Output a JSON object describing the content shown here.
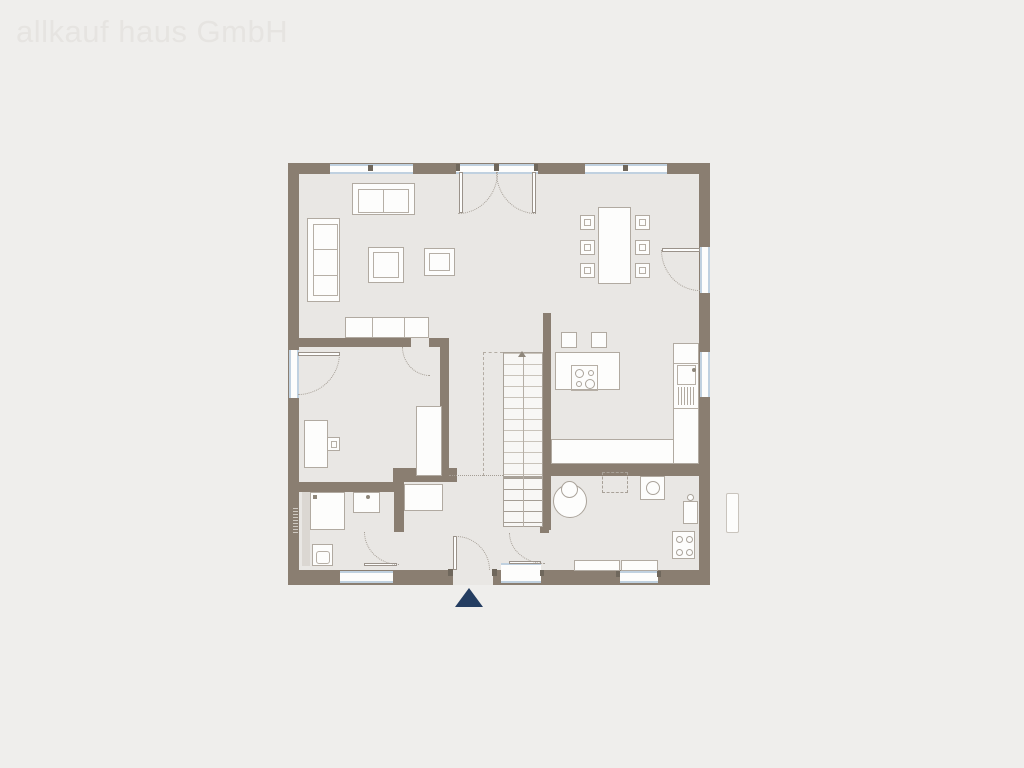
{
  "watermark": {
    "text": "allkauf haus GmbH"
  },
  "plan": {
    "kind": "ground-floor-plan",
    "colors": {
      "background": "#efeeec",
      "floor": "#e9e7e4",
      "wall": "#8a7e71",
      "window_accent": "#c0d1e0",
      "furniture_outline": "#b1aaa1",
      "door_swing": "#a59e95",
      "entrance_arrow": "#243d61",
      "watermark_text": "#e6e4e1"
    },
    "windows": [
      "living-room-window",
      "double-french-door",
      "dining-room-window",
      "terrace-door-window",
      "kitchen-window",
      "office-french-window",
      "bathroom-window",
      "entry-sidelight",
      "utility-window"
    ],
    "doors": [
      "double-french-door",
      "terrace-door",
      "office-french-door",
      "office-door",
      "bathroom-door",
      "front-door",
      "utility-room-door"
    ],
    "furniture": {
      "living_room": [
        "two-seat-sofa",
        "corner-sofa",
        "coffee-table",
        "side-table",
        "sideboard"
      ],
      "dining_area": [
        "dining-table",
        "dining-chair-x6"
      ],
      "kitchen": [
        "island-with-cooktop",
        "bar-stool-x2",
        "counter-with-sink-and-drainer",
        "base-counter"
      ],
      "hallway": [
        "staircase",
        "hall-closet"
      ],
      "office": [
        "desk",
        "desk-chair",
        "wardrobe"
      ],
      "bathroom": [
        "shower",
        "washbasin",
        "wc"
      ],
      "utility_room": [
        "round-basin",
        "appliance-placeholder",
        "washing-machine",
        "fridge",
        "stove",
        "cabinet-x2"
      ],
      "exterior": [
        "outdoor-unit",
        "entrance-arrow"
      ]
    }
  }
}
